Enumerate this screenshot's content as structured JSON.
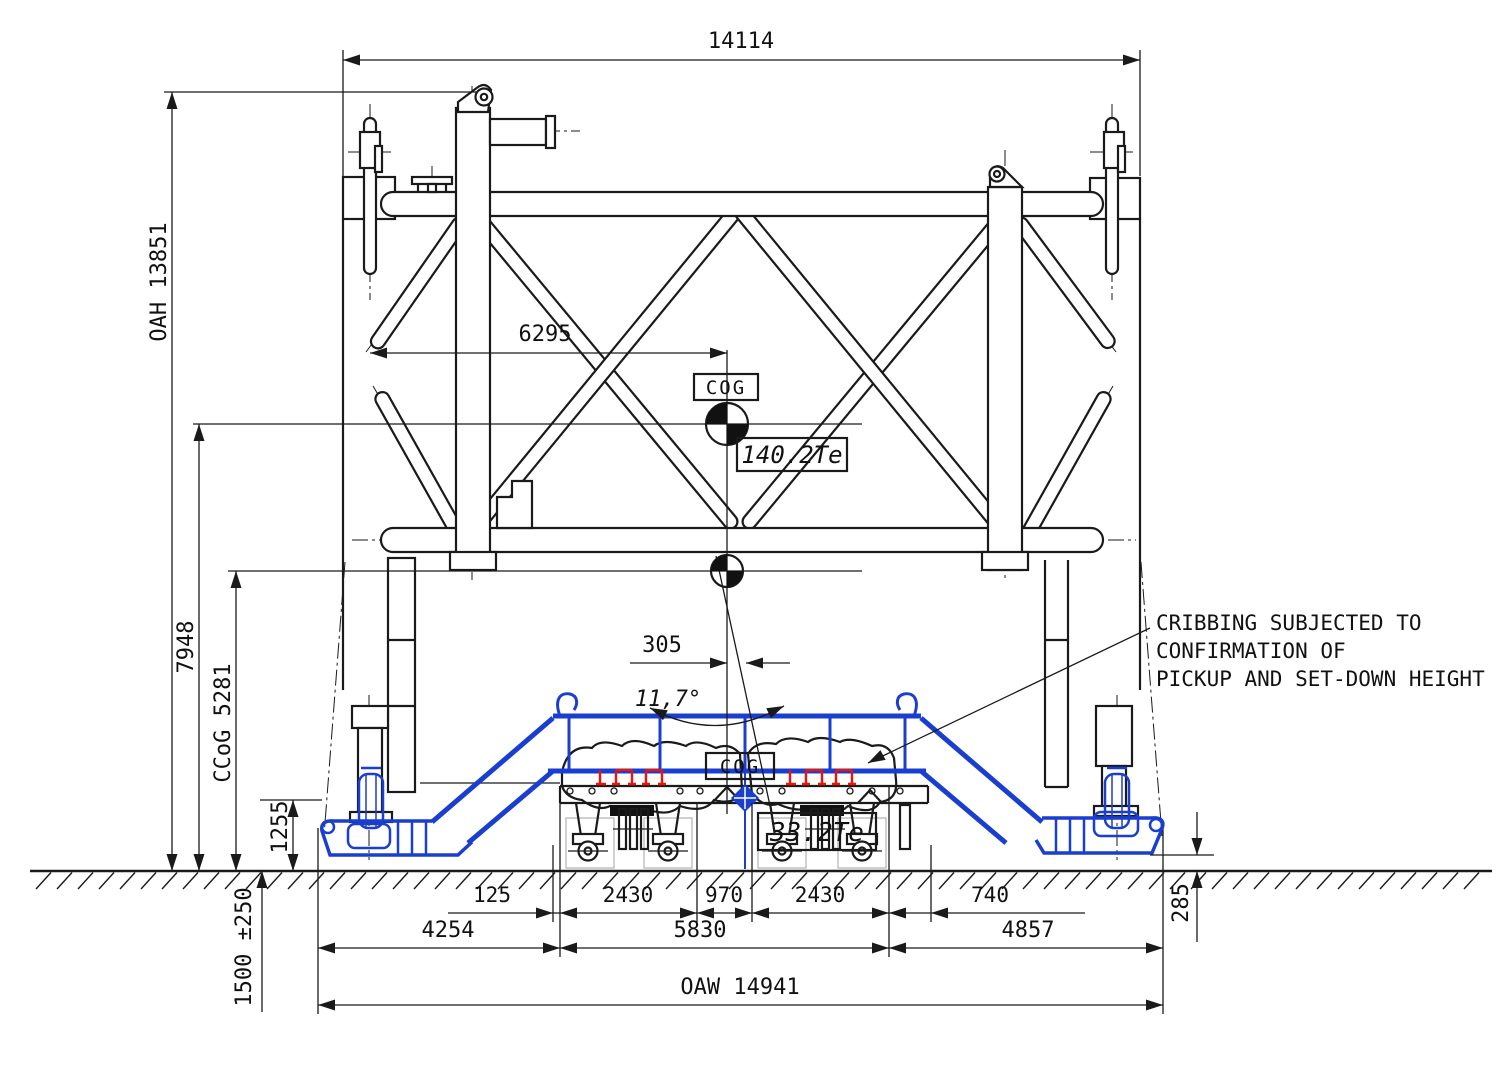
{
  "drawing": {
    "title": "Transport / lifting arrangement elevation",
    "dims": {
      "top_width": "14114",
      "oah": "OAH 13851",
      "h7948": "7948",
      "ccog": "CCoG 5281",
      "h1255": "1255",
      "travel_height": "1500 ±250",
      "cog_offset": "6295",
      "offset_305": "305",
      "tilt_angle": "11,7°",
      "d125": "125",
      "d2430a": "2430",
      "d970": "970",
      "d2430b": "2430",
      "d740": "740",
      "d4254": "4254",
      "d5830": "5830",
      "d4857": "4857",
      "d285": "285",
      "oaw": "OAW 14941"
    },
    "labels": {
      "cog_upper": "COG",
      "cog_lower": "COG",
      "weight_main": "140.2Te",
      "weight_cargo": "33.2Te",
      "note_line1": "CRIBBING SUBJECTED TO",
      "note_line2": "CONFIRMATION OF",
      "note_line3": "PICKUP AND SET-DOWN HEIGHT"
    },
    "colors": {
      "line": "#1a1a1a",
      "trailer_blue": "#1a3fd0",
      "tiedown_red": "#e8150d",
      "background": "#ffffff"
    }
  }
}
